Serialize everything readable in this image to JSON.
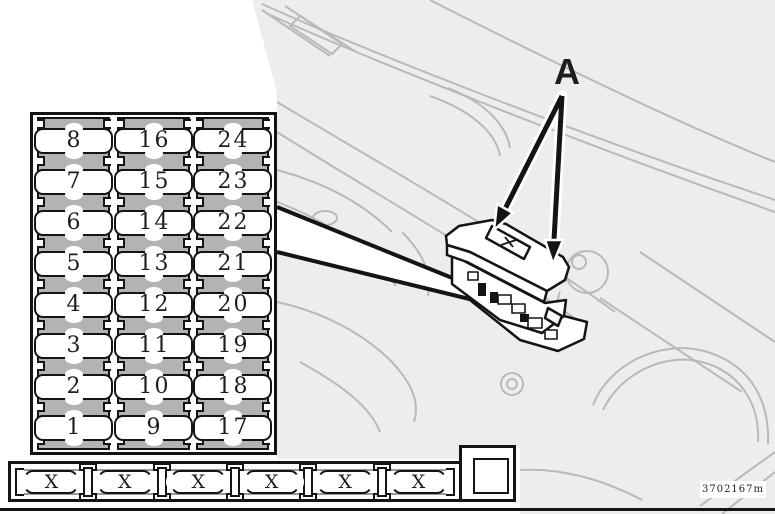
{
  "figure": {
    "callout_label": "A",
    "drawing_code": "3702167m"
  },
  "fuse_panel": {
    "columns": [
      {
        "fuses": [
          "8",
          "7",
          "6",
          "5",
          "4",
          "3",
          "2",
          "1"
        ]
      },
      {
        "fuses": [
          "16",
          "15",
          "14",
          "13",
          "12",
          "11",
          "10",
          "9"
        ]
      },
      {
        "fuses": [
          "24",
          "23",
          "22",
          "21",
          "20",
          "19",
          "18",
          "17"
        ]
      }
    ]
  },
  "spare_fuse_strip": {
    "slots": [
      "X",
      "X",
      "X",
      "X",
      "X",
      "X"
    ]
  },
  "colors": {
    "background": "#ffffff",
    "ink": "#141414",
    "strip_gray": "#b3b3b3",
    "line_art_gray": "#b9b9b9",
    "region_fill_gray": "#ededed"
  }
}
